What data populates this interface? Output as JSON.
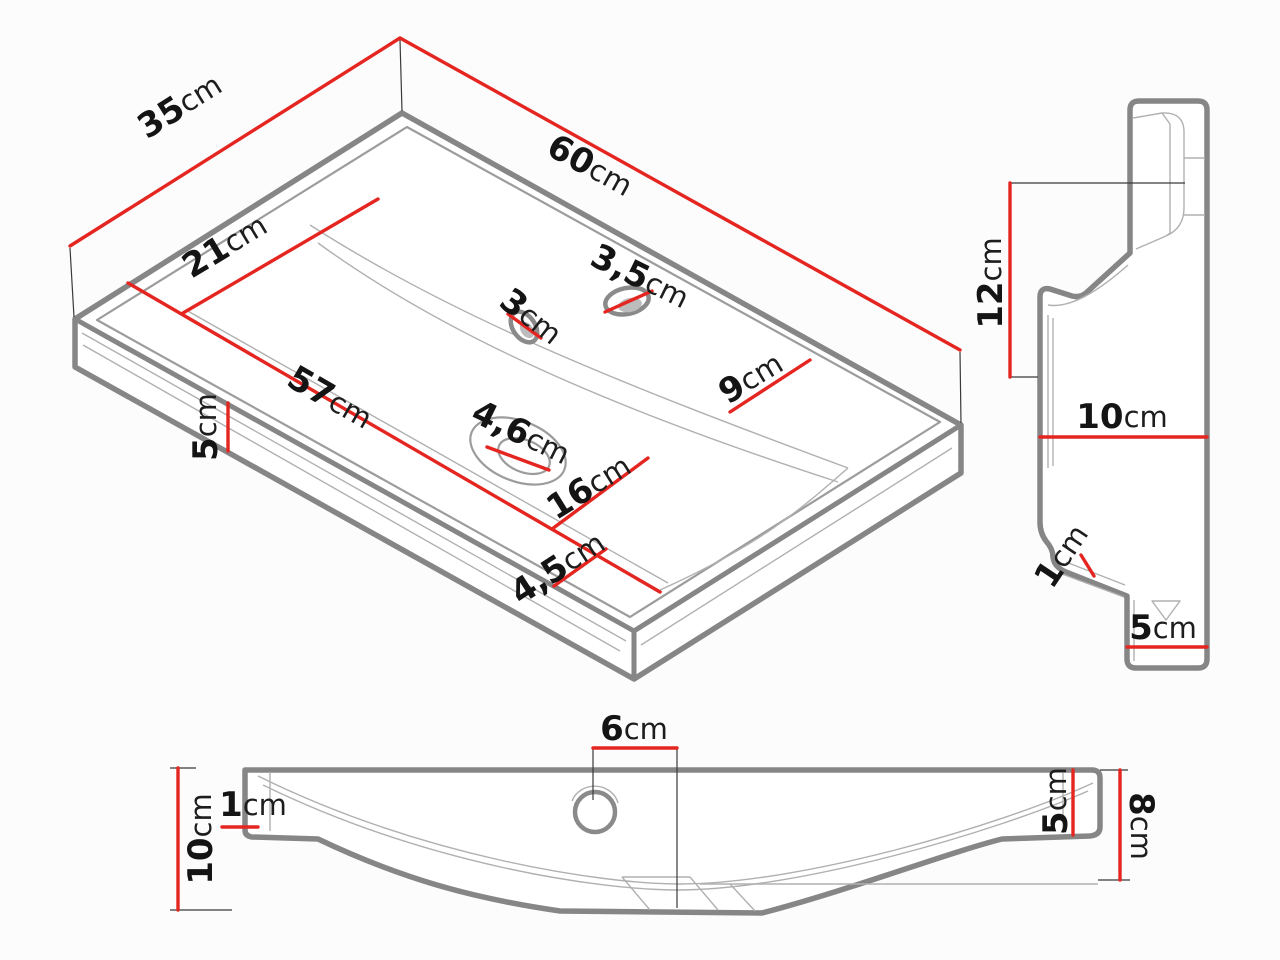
{
  "title": "Washbasin technical dimension drawing",
  "colors": {
    "dimension_red": "#e42520",
    "outline_gray": "#868686",
    "detail_gray": "#b0b0b0",
    "text_black": "#141414",
    "background": "#fcfcfc"
  },
  "views": {
    "isometric": {
      "name": "isometric-top-view",
      "dims": {
        "depth": {
          "n": "35",
          "u": "cm"
        },
        "length": {
          "n": "60",
          "u": "cm"
        },
        "basin_width": {
          "n": "21",
          "u": "cm"
        },
        "basin_length": {
          "n": "57",
          "u": "cm"
        },
        "apron_height": {
          "n": "5",
          "u": "cm"
        },
        "overflow_hole": {
          "n": "3",
          "u": "cm"
        },
        "faucet_hole": {
          "n": "3,5",
          "u": "cm"
        },
        "deck_right": {
          "n": "9",
          "u": "cm"
        },
        "drain_hole": {
          "n": "4,6",
          "u": "cm"
        },
        "basin_inner": {
          "n": "16",
          "u": "cm"
        },
        "front_rim": {
          "n": "4,5",
          "u": "cm"
        }
      }
    },
    "side": {
      "name": "side-profile-view",
      "dims": {
        "back_height": {
          "n": "12",
          "u": "cm"
        },
        "depth_top": {
          "n": "10",
          "u": "cm"
        },
        "drip_lip": {
          "n": "1",
          "u": "cm"
        },
        "depth_bottom": {
          "n": "5",
          "u": "cm"
        }
      }
    },
    "front": {
      "name": "front-section-view",
      "dims": {
        "height_left": {
          "n": "10",
          "u": "cm"
        },
        "rim_left": {
          "n": "1",
          "u": "cm"
        },
        "faucet_offset": {
          "n": "6",
          "u": "cm"
        },
        "rim_right": {
          "n": "5",
          "u": "cm"
        },
        "height_right": {
          "n": "8",
          "u": "cm"
        }
      }
    }
  }
}
